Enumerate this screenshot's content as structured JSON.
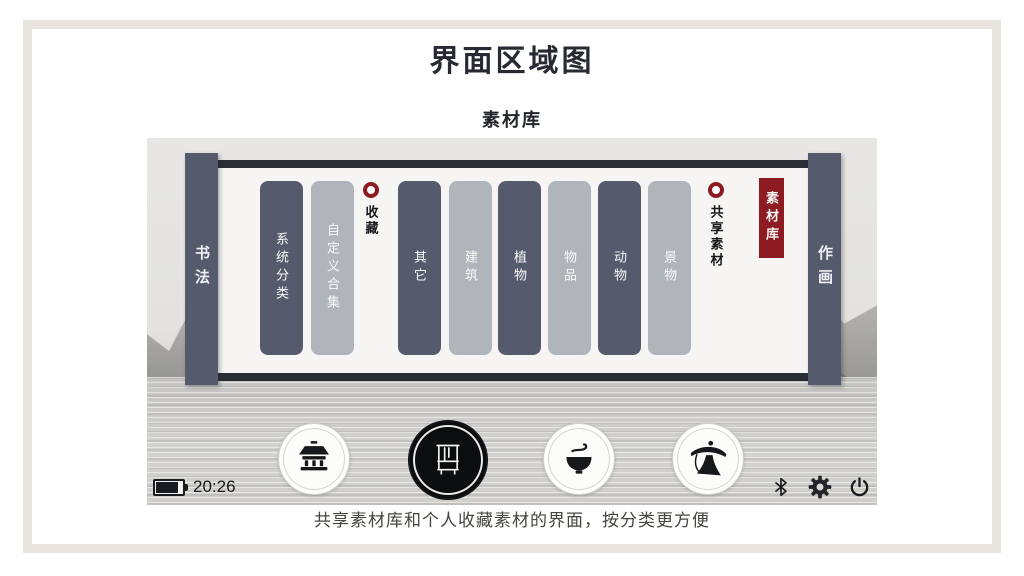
{
  "page": {
    "title": "界面区域图",
    "section_label": "素材库",
    "caption": "共享素材库和个人收藏素材的界面，按分类更方便"
  },
  "device": {
    "left_sidebar": "书法",
    "right_sidebar": "作画",
    "categories": [
      {
        "label": "系统分类",
        "variant": "dark"
      },
      {
        "label": "自定义合集",
        "variant": "light"
      },
      {
        "label": "其它",
        "variant": "dark"
      },
      {
        "label": "建筑",
        "variant": "light"
      },
      {
        "label": "植物",
        "variant": "dark"
      },
      {
        "label": "物品",
        "variant": "light"
      },
      {
        "label": "动物",
        "variant": "dark"
      },
      {
        "label": "景物",
        "variant": "light"
      }
    ],
    "markers": [
      {
        "label": "收藏"
      },
      {
        "label": "共享素材"
      }
    ],
    "active_badge": "素材库",
    "status": {
      "time": "20:26",
      "battery_level": "high"
    },
    "dock_icons": [
      "temple-icon",
      "brush-rack-icon",
      "tea-bowl-icon",
      "fisherman-icon"
    ],
    "system_icons": [
      "bluetooth-icon",
      "settings-gear-icon",
      "power-icon"
    ]
  },
  "colors": {
    "accent_red": "#8e1b22",
    "dark_slate": "#555a6c",
    "light_gray": "#b0b4bb",
    "rail_dark": "#2b2d35",
    "canvas": "#f6f5f3",
    "frame_border": "#e8e5df"
  }
}
